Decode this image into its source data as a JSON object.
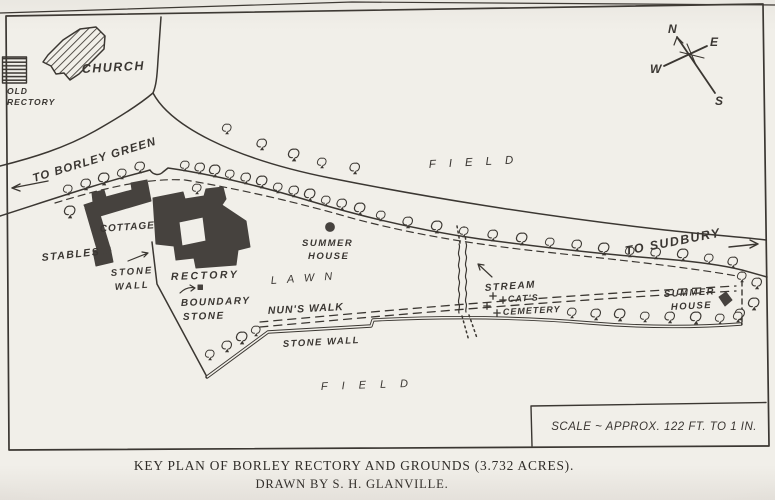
{
  "caption": {
    "line1": "KEY PLAN OF BORLEY RECTORY AND GROUNDS (3.732 ACRES).",
    "line2": "DRAWN BY S. H. GLANVILLE."
  },
  "map": {
    "colors": {
      "paper": "#f1efe9",
      "ink": "#3b3732",
      "building": "#46423e"
    },
    "compass": {
      "n": "N",
      "e": "E",
      "w": "W",
      "s": "S"
    },
    "labels": {
      "church": "CHURCH",
      "old_rectory_1": "OLD",
      "old_rectory_2": "RECTORY",
      "to_borley_green": "TO BORLEY GREEN",
      "field_top": "FIELD",
      "to_sudbury": "TO SUDBURY",
      "cottage": "COTTAGE",
      "stables": "STABLES",
      "stone_wall_left_1": "STONE",
      "stone_wall_left_2": "WALL",
      "rectory": "RECTORY",
      "boundary_stone_1": "BOUNDARY",
      "boundary_stone_2": "STONE",
      "lawn": "LAWN",
      "nuns_walk": "NUN'S WALK",
      "summer_house_center_1": "SUMMER",
      "summer_house_center_2": "HOUSE",
      "stream": "STREAM",
      "cats_cemetery_1": "CAT'S",
      "cats_cemetery_2": "CEMETERY",
      "summer_house_right_1": "SUMMER",
      "summer_house_right_2": "HOUSE",
      "stone_wall_bottom": "STONE WALL",
      "field_bottom": "FIELD",
      "scale": "SCALE ~ APPROX. 122 FT. TO 1 IN."
    },
    "trees": {
      "hedge_row": [
        [
          185,
          171
        ],
        [
          200,
          174
        ],
        [
          215,
          177
        ],
        [
          230,
          180
        ],
        [
          246,
          184
        ],
        [
          262,
          188
        ],
        [
          278,
          193
        ],
        [
          294,
          197
        ],
        [
          310,
          201
        ],
        [
          326,
          206
        ],
        [
          342,
          210
        ],
        [
          360,
          215
        ],
        [
          381,
          221
        ],
        [
          408,
          228
        ],
        [
          437,
          233
        ],
        [
          464,
          237
        ],
        [
          493,
          241
        ],
        [
          522,
          245
        ],
        [
          550,
          248
        ],
        [
          577,
          251
        ],
        [
          604,
          255
        ],
        [
          630,
          257
        ],
        [
          656,
          259
        ],
        [
          683,
          261
        ],
        [
          709,
          264
        ],
        [
          733,
          268
        ]
      ],
      "road_left": [
        [
          68,
          195
        ],
        [
          86,
          190
        ],
        [
          104,
          185
        ],
        [
          122,
          179
        ],
        [
          140,
          173
        ],
        [
          70,
          218
        ],
        [
          197,
          194
        ]
      ],
      "road_north": [
        [
          227,
          134
        ],
        [
          262,
          150
        ],
        [
          294,
          161
        ],
        [
          322,
          168
        ],
        [
          355,
          174
        ]
      ],
      "wall_southwest": [
        [
          210,
          360
        ],
        [
          227,
          352
        ],
        [
          242,
          344
        ],
        [
          256,
          336
        ]
      ],
      "wall_south": [
        [
          572,
          318
        ],
        [
          596,
          320
        ],
        [
          620,
          321
        ],
        [
          645,
          322
        ],
        [
          670,
          323
        ],
        [
          696,
          324
        ],
        [
          720,
          324
        ],
        [
          740,
          320
        ]
      ],
      "east_strip": [
        [
          742,
          282
        ],
        [
          757,
          289
        ],
        [
          754,
          310
        ],
        [
          738,
          322
        ]
      ]
    },
    "cemetery_crosses": [
      [
        493,
        296
      ],
      [
        487,
        306
      ],
      [
        497,
        313
      ],
      [
        503,
        300
      ]
    ]
  }
}
